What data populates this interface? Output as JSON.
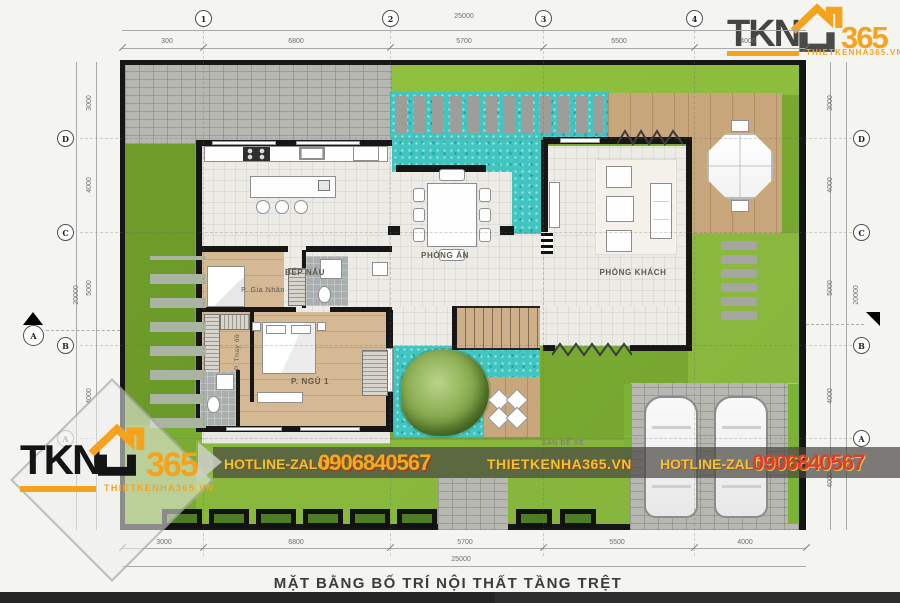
{
  "title": "MẶT BẰNG BỐ TRÍ NỘI THẤT TẦNG TRỆT",
  "logo": {
    "brand": "TKN",
    "num": "365",
    "site": "THIETKENHA365.VN"
  },
  "hotline": {
    "label": "HOTLINE-ZALO:",
    "phone": "0906840567",
    "site": "THIETKENHA365.VN"
  },
  "grid": {
    "cols": [
      "1",
      "2",
      "3",
      "4"
    ],
    "rows": [
      "D",
      "C",
      "B",
      "A"
    ],
    "section": "A"
  },
  "dims": {
    "h_top_total": "25000",
    "h_top": [
      "300",
      "6800",
      "5700",
      "5500",
      "4000"
    ],
    "h_bottom": [
      "3000",
      "6800",
      "5700",
      "5500",
      "4000"
    ],
    "h_bottom_total": "25000",
    "v": [
      "3000",
      "4000",
      "5000",
      "4000",
      "4000"
    ],
    "v_total": "20000"
  },
  "rooms": {
    "kitchen": "BẾP NẤU",
    "dining": "PHÒNG ĂN",
    "living": "PHÒNG KHÁCH",
    "maid": "P. Gia Nhân",
    "dressing": "P. Thay đồ",
    "bedroom1": "P. NGỦ 1",
    "parking": "SÂN ĐỂ XE"
  },
  "colors": {
    "accent_orange": "#F5A31D",
    "hotline_yellow": "#F2C230",
    "hotline_red": "#E23B2A",
    "pool_teal": "#40C5C1",
    "grass_green": "#7CAB33"
  }
}
